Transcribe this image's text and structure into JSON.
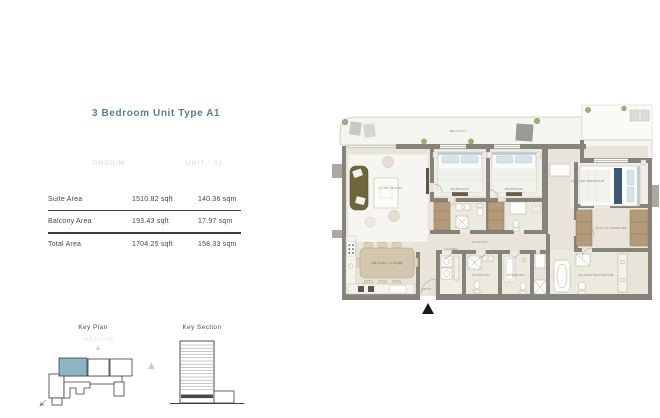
{
  "header": {
    "title": "3 Bedroom Unit Type A1",
    "level": "PODIUM",
    "unit": "UNIT - 03"
  },
  "area_table": {
    "rows": [
      {
        "label": "Suite Area",
        "sqft": "1510.82 sqft",
        "sqm": "140.36 sqm"
      },
      {
        "label": "Balcony Area",
        "sqft": "193.43 sqft",
        "sqm": "17.97 sqm"
      },
      {
        "label": "Total Area",
        "sqft": "1704.25 sqft",
        "sqm": "158.33 sqm"
      }
    ]
  },
  "key_plan": {
    "title": "Key Plan",
    "subtitle": "PODIUM"
  },
  "key_section": {
    "title": "Key Section"
  },
  "floor_plan": {
    "labels": {
      "balcony": "BALCONY",
      "living": "LIVING ROOM",
      "bedroom1": "BEDROOM",
      "bedroom2": "BEDROOM",
      "master_bedroom": "MASTER BEDROOM",
      "kitchen_dining": "KITCHEN / DINING",
      "hallway": "HALLWAY",
      "laundry": "LAUNDRY",
      "bathroom1": "BATHROOM",
      "bathroom2": "BATHROOM",
      "master_bathroom": "MASTER BATHROOM",
      "walk_in_wardrobe": "WALK-IN WARDROBE",
      "entry": "ENTRY"
    }
  },
  "colors": {
    "accent_teal": "#5b7f8f",
    "key_plan_highlight": "#8cb5c4",
    "wall_gray": "#86837a",
    "floor_beige": "#e9e4d9",
    "wood": "#b59a79",
    "sofa_olive": "#6f663c"
  }
}
